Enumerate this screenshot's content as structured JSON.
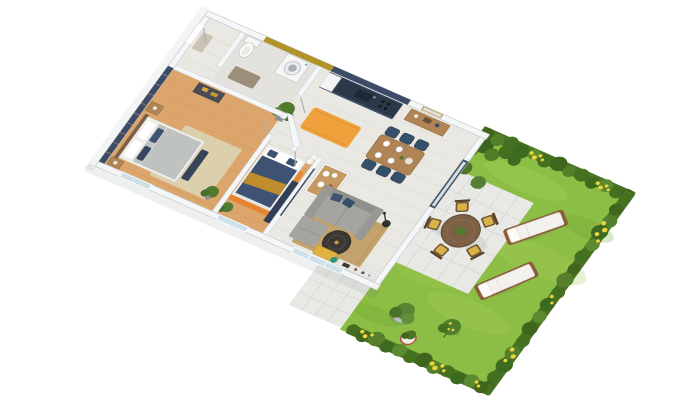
{
  "title": "isometric-3d-floor-plan-render",
  "palette": {
    "background": "#ffffff",
    "wall": "#f4f6f7",
    "wall_edge": "#c9ced3",
    "tile_floor": "#eae8e3",
    "bath_floor": "#e4e2dc",
    "wood_floor": "#dca56c",
    "navy": "#3d4b66",
    "navy_dark": "#2c3748",
    "navy_textile": "#3e5273",
    "mustard": "#b2932a",
    "mustard_throw": "#bf8c2e",
    "orange": "#efa23c",
    "orange_deep": "#e8832f",
    "tan_rug": "#c3a36b",
    "beige_rug": "#dccfab",
    "gray_sofa": "#a4a5a1",
    "gray_bed": "#bfc3c0",
    "yellow": "#e0b23f",
    "teal": "#2e8f86",
    "wood": "#b08455",
    "wood_dark": "#7d6045",
    "charcoal": "#3b3733",
    "white_furniture": "#f4f4f2",
    "lawn": "#8cbd44",
    "lawn_light": "#a9d25f",
    "hedge": "#4a7424",
    "hedge_dark": "#3f661c",
    "hedge_light": "#5c8a2e",
    "flower_yellow": "#ecd33f",
    "terrace": "#e8e9e5",
    "glass": "#cfe0ea",
    "plant_green": "#4f7a30",
    "shadow": "#5b6770"
  },
  "scene": {
    "view": "rotated isometric 3D floor plan of an apartment with private garden",
    "areas": [
      {
        "name": "entry",
        "items": [
          "entry-door",
          "doormat"
        ]
      },
      {
        "name": "bathroom",
        "items": [
          "toilet",
          "washing-machine",
          "bath-mat",
          "mustard-accent-wall"
        ]
      },
      {
        "name": "kitchen",
        "items": [
          "navy-counter-run",
          "sink",
          "hob",
          "fridge",
          "orange-rug",
          "potted-plant",
          "island-with-dishes"
        ]
      },
      {
        "name": "dining-area",
        "items": [
          "wood-table",
          "navy-chairs-x6",
          "place-settings",
          "sideboard",
          "wall-mirror"
        ]
      },
      {
        "name": "living-room",
        "items": [
          "gray-corner-sofa",
          "round-coffee-table",
          "tan-rug",
          "yellow-bench",
          "tv-console",
          "teal-vase",
          "floor-lamp",
          "glass-slider"
        ]
      },
      {
        "name": "bedroom-1",
        "items": [
          "gray-bed",
          "navy-slat-accent-wall",
          "beige-rug",
          "dresser",
          "nightstands-x2",
          "foot-bench",
          "plant"
        ]
      },
      {
        "name": "bedroom-2",
        "items": [
          "navy-bed",
          "mustard-throw",
          "orange-rug",
          "wardrobe",
          "bedside-lamps-x2",
          "plant"
        ]
      },
      {
        "name": "terrace",
        "items": [
          "round-outdoor-table",
          "chairs-with-yellow-cushions-x5",
          "potted-shrubs-x2",
          "walkway"
        ]
      },
      {
        "name": "garden",
        "items": [
          "lawn",
          "hedge-borders",
          "yellow-flower-bushes",
          "sun-loungers-x2",
          "trees",
          "striped-planter",
          "olive-tree-in-pot"
        ]
      }
    ],
    "window_count": 3,
    "dining_chair_count": 6,
    "terrace_chair_count": 5,
    "sun_lounger_count": 2
  }
}
